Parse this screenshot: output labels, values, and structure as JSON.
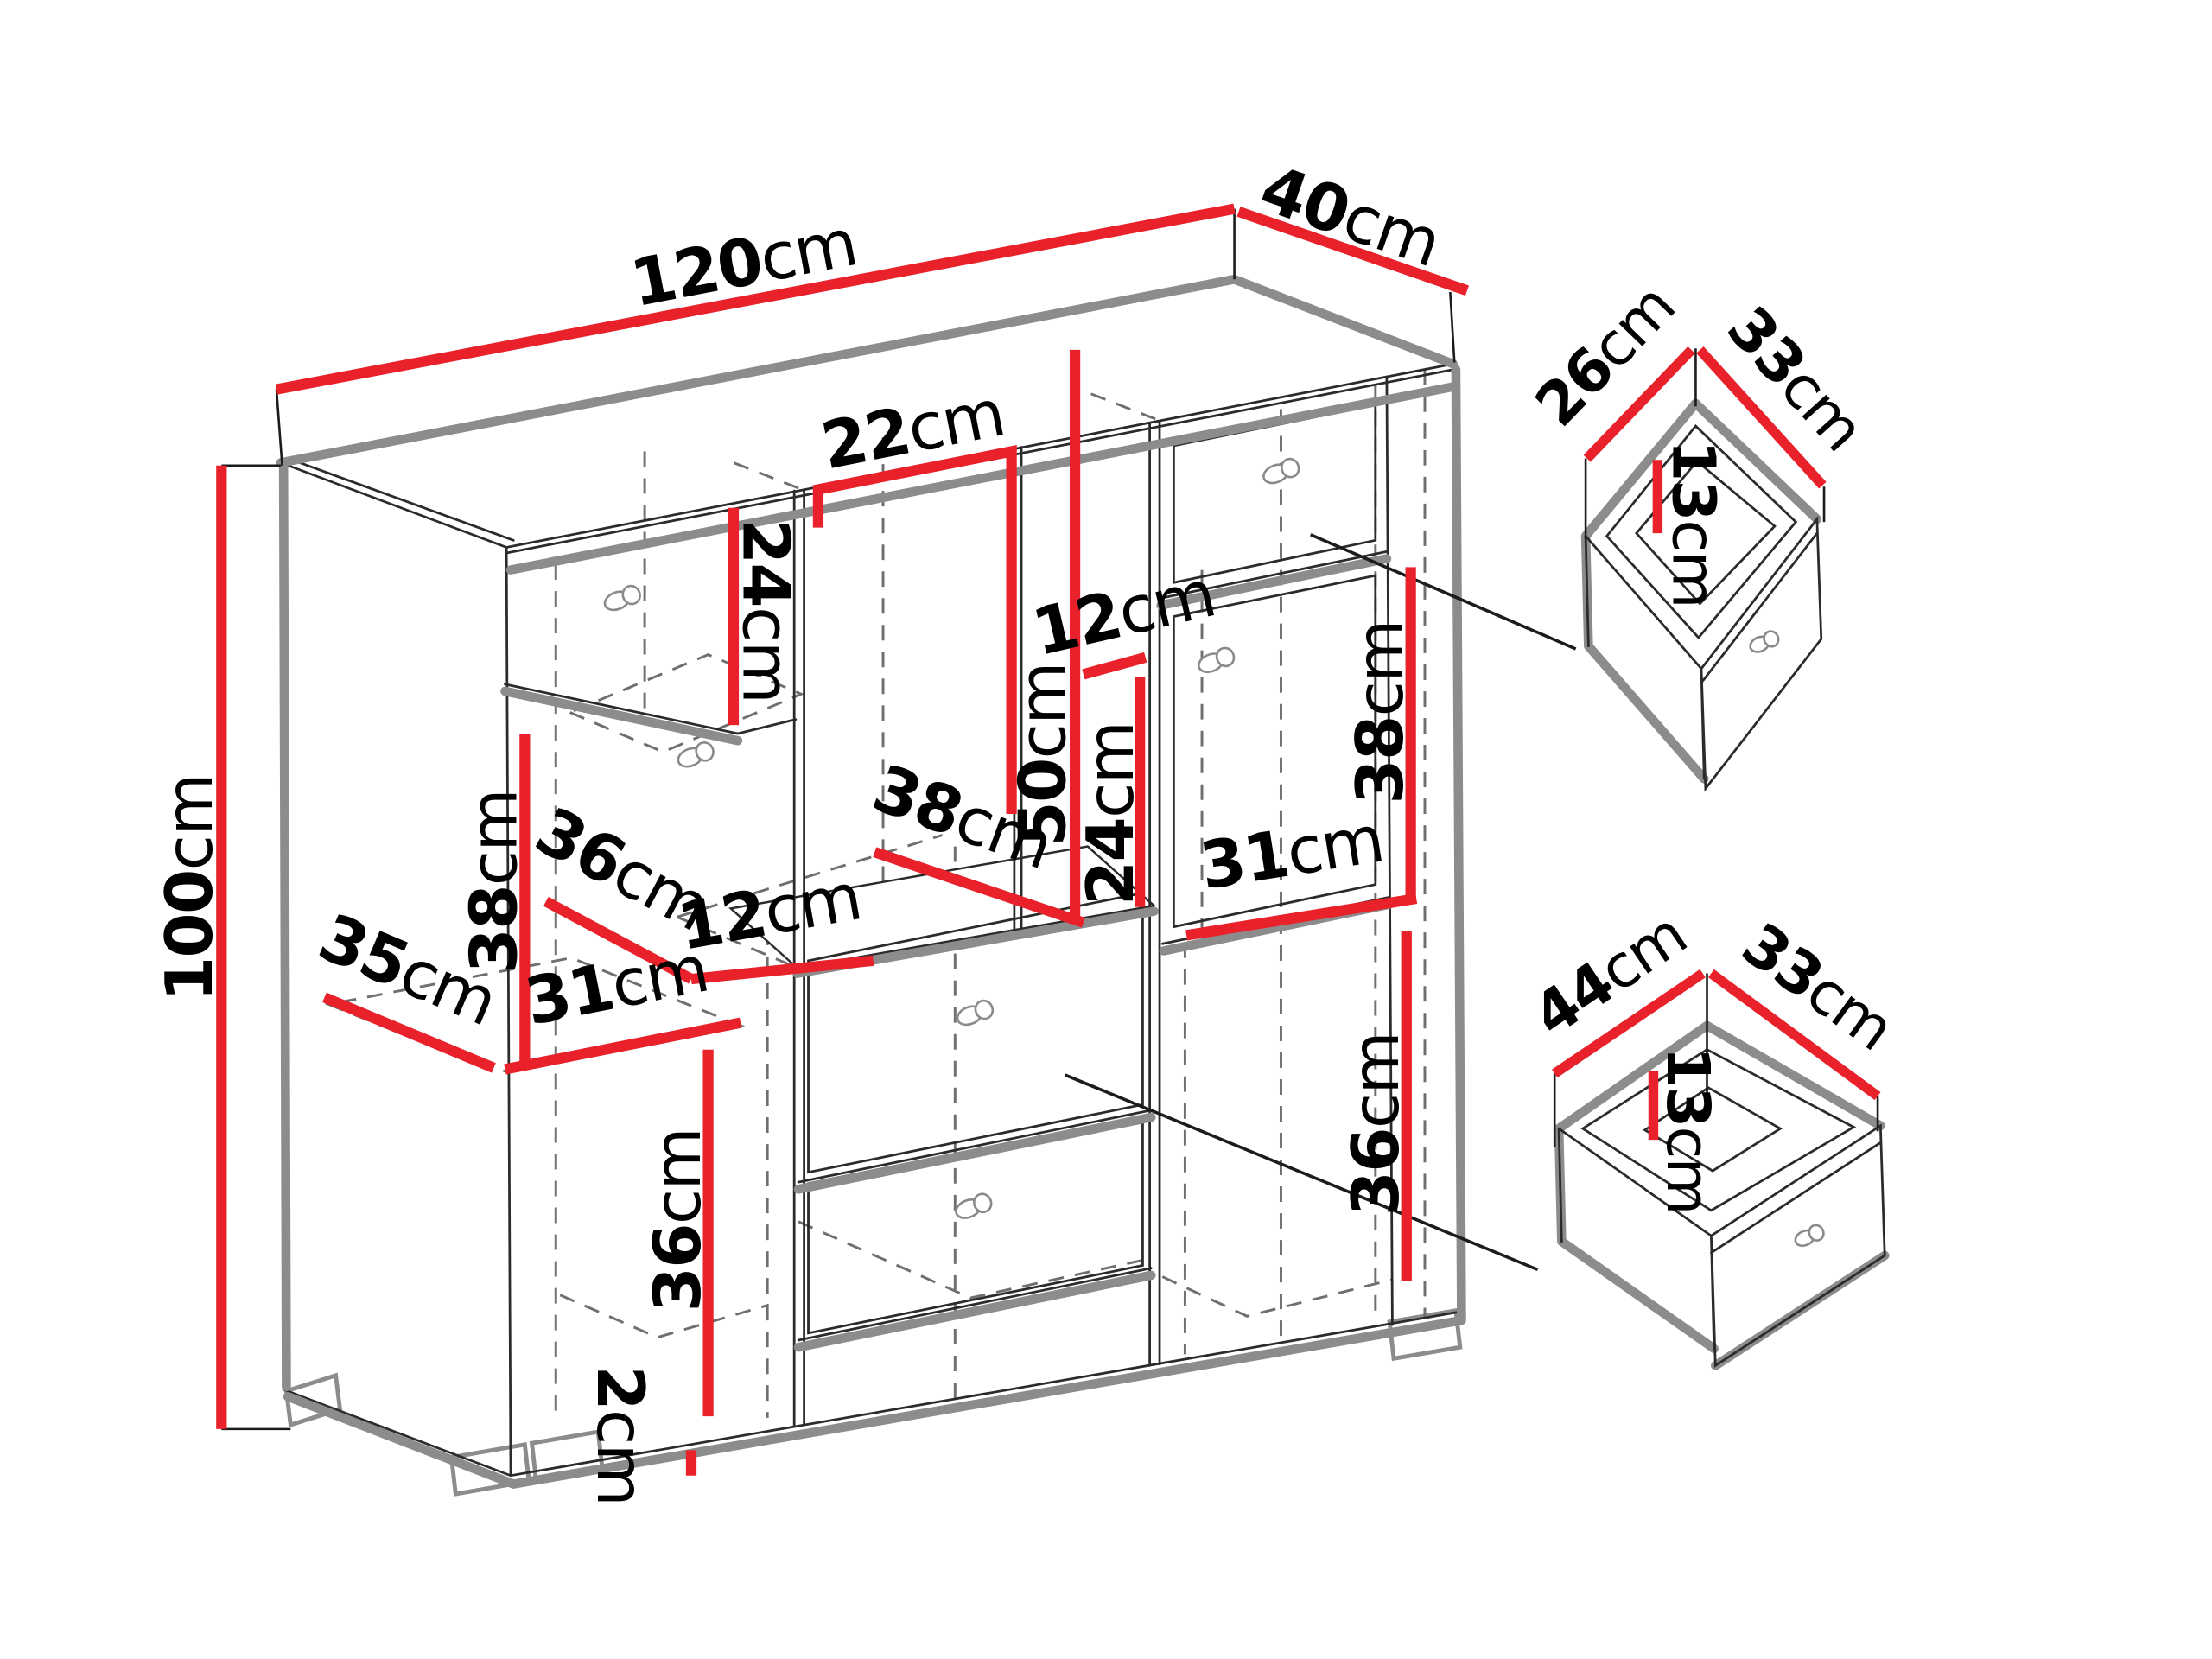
{
  "diagram_type": "furniture-dimension-drawing",
  "colors": {
    "dimension_line": "#e8212b",
    "edge_gray": "#8c8c8c",
    "outline_black": "#2b2b2b",
    "hidden_dash_gray": "#6f6f6f",
    "background": "#ffffff",
    "label_text": "#000000"
  },
  "cabinet": {
    "overall": {
      "width": {
        "value": "120",
        "unit": "cm"
      },
      "depth": {
        "value": "40",
        "unit": "cm"
      },
      "height": {
        "value": "100",
        "unit": "cm"
      },
      "foot_height": {
        "value": "2",
        "unit": "cm"
      }
    },
    "internal": {
      "top_shelf_width": {
        "value": "22",
        "unit": "cm"
      },
      "upper_left_shelf_height": {
        "value": "24",
        "unit": "cm"
      },
      "center_opening_height": {
        "value": "50",
        "unit": "cm"
      },
      "upper_gap_width": {
        "value": "12",
        "unit": "cm"
      },
      "center_shelf_height": {
        "value": "24",
        "unit": "cm"
      },
      "right_door_height": {
        "value": "38",
        "unit": "cm"
      },
      "left_opening_height": {
        "value": "38",
        "unit": "cm"
      },
      "left_shelf_depth": {
        "value": "36",
        "unit": "cm"
      },
      "center_shelf_depth": {
        "value": "38",
        "unit": "cm"
      },
      "center_gap_width": {
        "value": "12",
        "unit": "cm"
      },
      "right_opening_width": {
        "value": "31",
        "unit": "cm"
      },
      "lower_left_shelf_depth": {
        "value": "35",
        "unit": "cm"
      },
      "left_opening_width": {
        "value": "31",
        "unit": "cm"
      },
      "left_door_height": {
        "value": "36",
        "unit": "cm"
      },
      "right_lower_opening_height": {
        "value": "36",
        "unit": "cm"
      }
    }
  },
  "drawer_small": {
    "depth": {
      "value": "26",
      "unit": "cm"
    },
    "width": {
      "value": "33",
      "unit": "cm"
    },
    "height": {
      "value": "13",
      "unit": "cm"
    }
  },
  "drawer_large": {
    "depth": {
      "value": "44",
      "unit": "cm"
    },
    "width": {
      "value": "33",
      "unit": "cm"
    },
    "height": {
      "value": "13",
      "unit": "cm"
    }
  }
}
